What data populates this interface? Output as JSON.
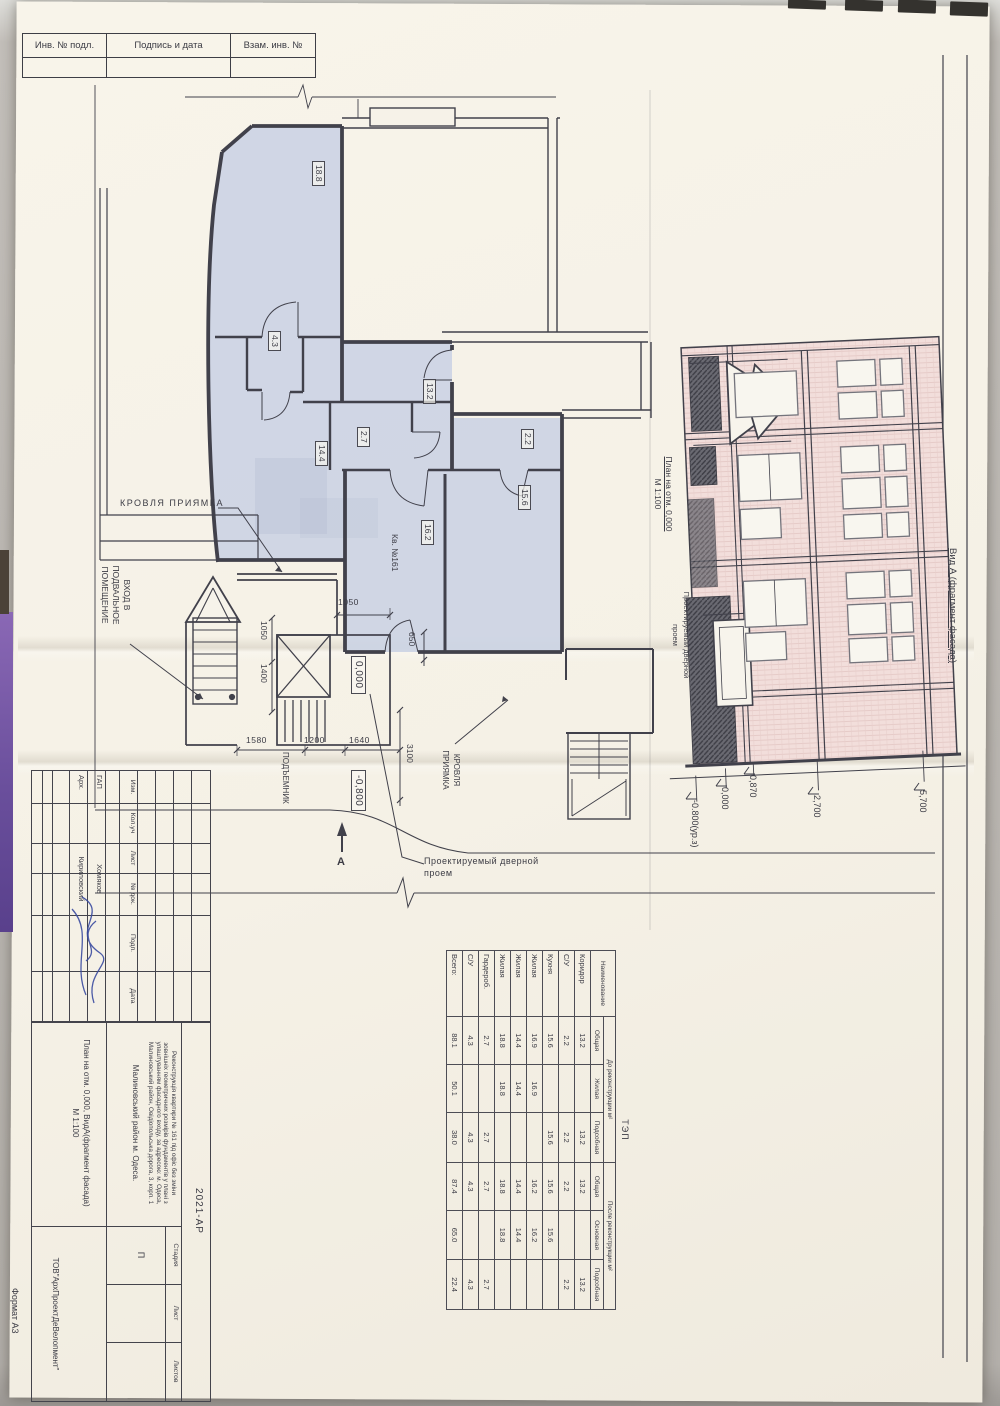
{
  "colors": {
    "sheet": "#f6f2e8",
    "plan_fill": "#ccd4e4",
    "facade_pink": "#f2dedb",
    "ink": "#41414b",
    "pen_blue": "#3a4aa0",
    "backdrop_purple": "#7a5ca8"
  },
  "stamps": {
    "cells": [
      "Инв. № подл.",
      "Подпись и дата",
      "Взам. инв. №"
    ]
  },
  "plan": {
    "kv_label": "Кв. №161",
    "rooms": {
      "r188": "18.8",
      "r43": "4.3",
      "r132": "13.2",
      "r27": "2.7",
      "r144": "14.4",
      "r22": "2.2",
      "r162": "16.2",
      "r156": "15.6"
    },
    "levels": {
      "zero": "0,000",
      "minus": "-0,800"
    },
    "dims": {
      "d1050a": "1050",
      "d1050b": "1050",
      "d1400": "1400",
      "d650": "650",
      "d1580": "1580",
      "d1200": "1200",
      "d1640": "1640",
      "d3100": "3100"
    },
    "annotations": {
      "krovlya1": "КРОВЛЯ ПРИЯМКА",
      "krovlya2_l1": "КРОВЛЯ",
      "krovlya2_l2": "ПРИЯМКА",
      "vhod_l1": "ВХОД В",
      "vhod_l2": "ПОДВАЛЬНОЕ",
      "vhod_l3": "ПОМЕЩЕНИЕ",
      "podyemnik": "ПОДЪЕМНИК",
      "door_l1": "Проектируемый дверной",
      "door_l2": "проем",
      "section_mark": "А"
    }
  },
  "facade": {
    "title": "Вид А (фрагмент фасада)",
    "plan_ref_l1": "План на отм. 0,000",
    "plan_ref_l2": "М 1:100",
    "door_note_l1": "Проектируемый дверной",
    "door_note_l2": "проем",
    "levels": {
      "l1": "0,870",
      "l2": "0,000",
      "l3": "-0.800(ур.з)",
      "l4": "2,700",
      "l5": "5,700"
    }
  },
  "tep": {
    "title": "ТЭП",
    "col_name": "Наименование",
    "group_before": "До реконструкции м²",
    "group_after": "После реконструкции м²",
    "sub": [
      "Общая",
      "Жилая",
      "Подсобная",
      "Общая",
      "Основная",
      "Подсобная"
    ],
    "rows": [
      [
        "Коридор",
        "13.2",
        "",
        "13.2",
        "13.2",
        "",
        "13.2"
      ],
      [
        "С/У",
        "2.2",
        "",
        "2.2",
        "2.2",
        "",
        "2.2"
      ],
      [
        "Кухня",
        "15.6",
        "",
        "15.6",
        "15.6",
        "15.6",
        ""
      ],
      [
        "Жилая",
        "16.9",
        "16.9",
        "",
        "16.2",
        "16.2",
        ""
      ],
      [
        "Жилая",
        "14.4",
        "14.4",
        "",
        "14.4",
        "14.4",
        ""
      ],
      [
        "Жилая",
        "18.8",
        "18.8",
        "",
        "18.8",
        "18.8",
        ""
      ],
      [
        "Гардероб.",
        "2.7",
        "",
        "2.7",
        "2.7",
        "",
        "2.7"
      ],
      [
        "С/У",
        "4.3",
        "",
        "4.3",
        "4.3",
        "",
        "4.3"
      ],
      [
        "Всего:",
        "88.1",
        "50.1",
        "38.0",
        "87.4",
        "65.0",
        "22.4"
      ]
    ]
  },
  "titleblock": {
    "doc_code": "2021-АР",
    "desc_l1": "Реконструкція квартири № 161 під офіс без зміни",
    "desc_l2": "зовнішніх геометричних розмірів фундаментів у плані з",
    "desc_l3": "улаштуванням фасадного входу, за адресою: м. Одеса,",
    "desc_l4": "Малиновський район, Овідіопольська дорога, 3, корп. 1",
    "district": "Малиновський район м. Одеса.",
    "sheet_title_l1": "План на отм. 0,000, ВидА(фрагмент фасада)",
    "sheet_title_l2": "М 1:100",
    "stage_label": "Стадия",
    "sheet_label": "Лист",
    "sheets_label": "Листов",
    "stage_value": "П",
    "company": "ТОВ\"АрхПроектДеВелопмент\"",
    "cols": [
      "Изм.",
      "Кол.уч",
      "Лист",
      "№ док.",
      "Подп.",
      "Дата"
    ],
    "row1_role": "ГАП",
    "row1_name": "Хомяков",
    "row2_role": "Арх.",
    "row2_name": "Кириловский"
  },
  "format_label": "Формат А3"
}
